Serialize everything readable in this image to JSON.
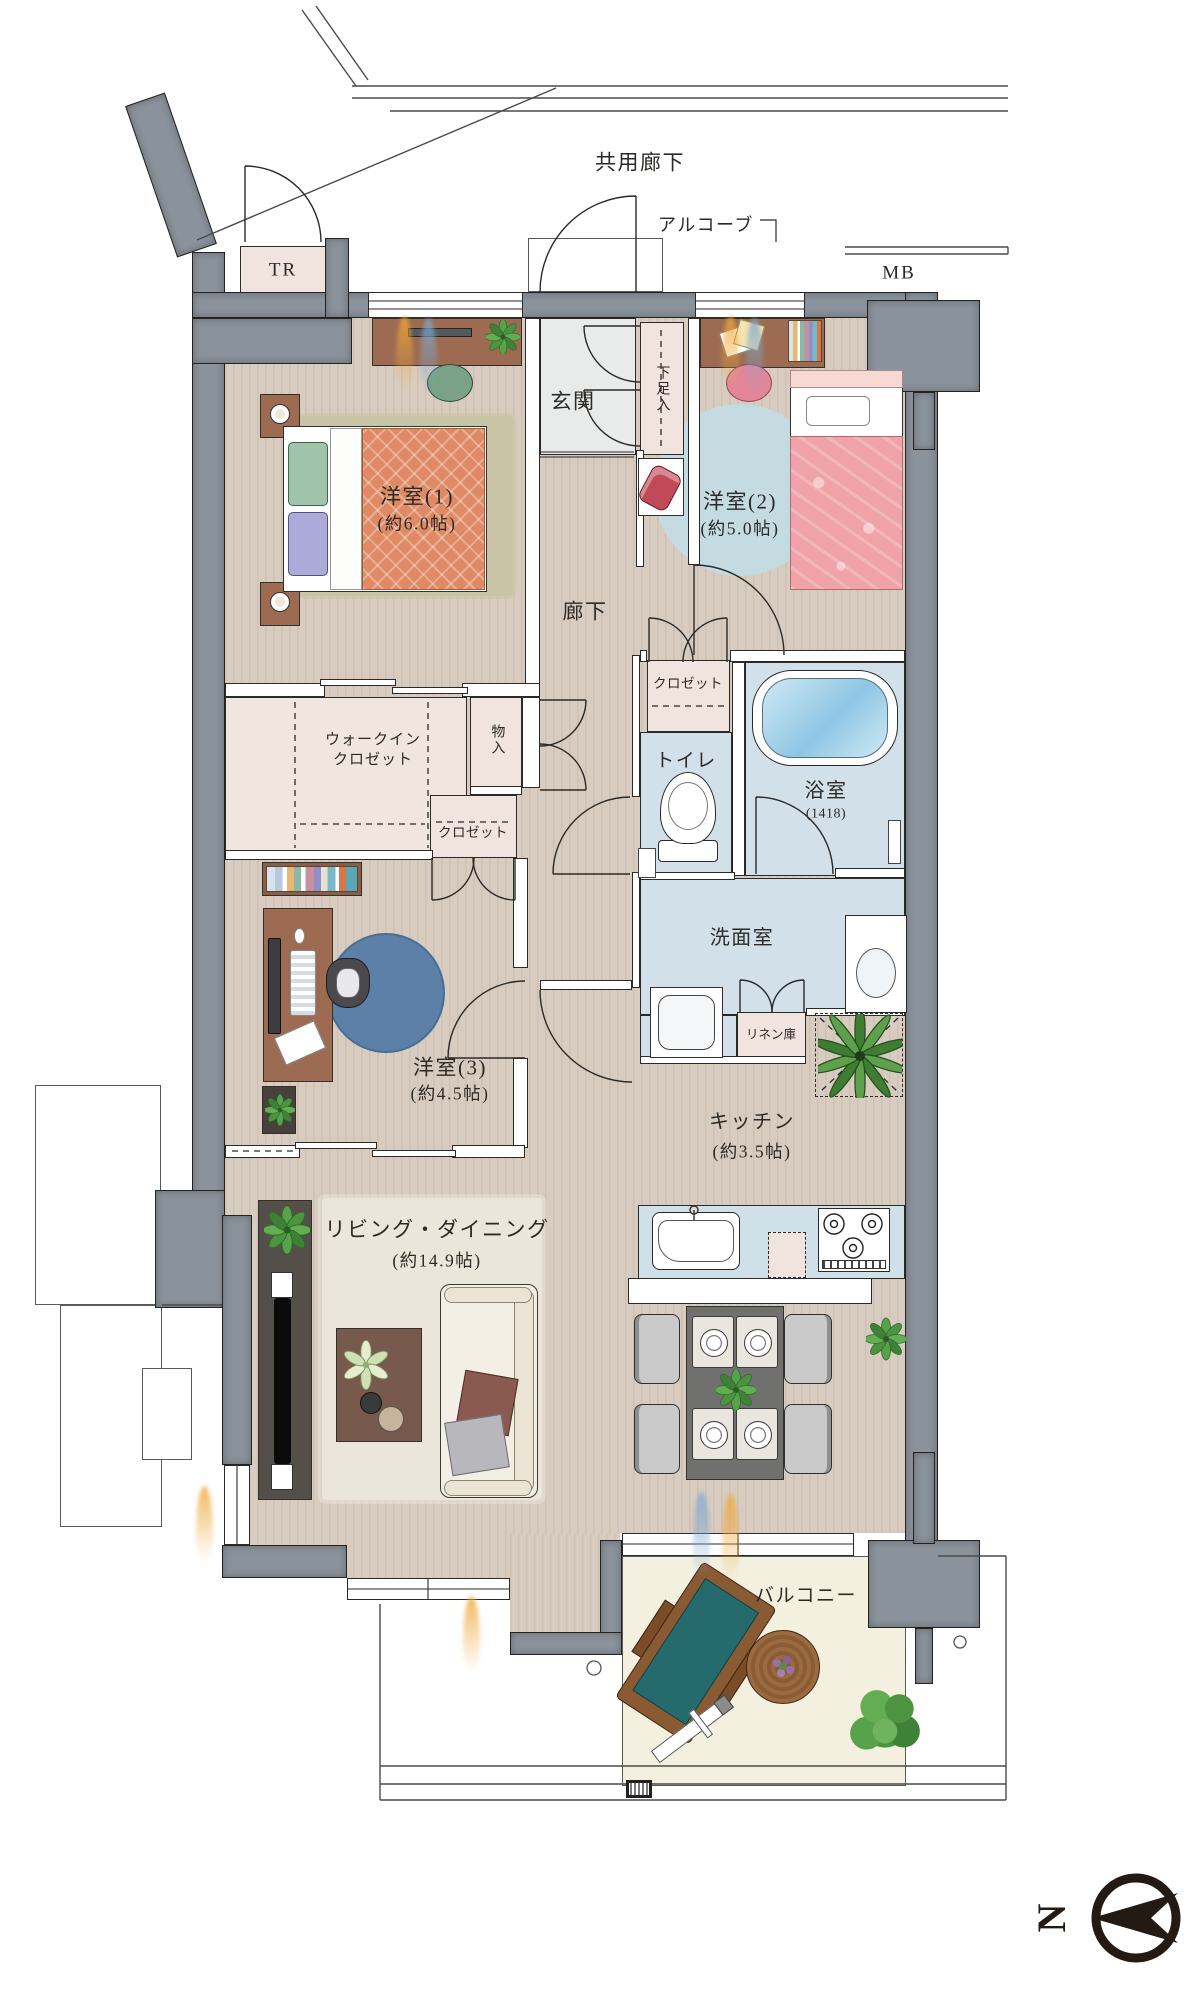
{
  "exterior": {
    "common_corridor": "共用廊下",
    "alcove": "アルコーブ",
    "trunk_room": "TR",
    "meter_box": "MB",
    "compass_north": "N"
  },
  "rooms": {
    "entrance": {
      "label": "玄関"
    },
    "shoe_cabinet": {
      "label": "下足入"
    },
    "western_room_1": {
      "label": "洋室(1)",
      "area": "(約6.0帖)"
    },
    "western_room_2": {
      "label": "洋室(2)",
      "area": "(約5.0帖)"
    },
    "western_room_3": {
      "label": "洋室(3)",
      "area": "(約4.5帖)"
    },
    "hallway": {
      "label": "廊下"
    },
    "closet_room2": {
      "label": "クロゼット"
    },
    "closet_room3": {
      "label": "クロゼット"
    },
    "walk_in_closet": {
      "label_line1": "ウォークイン",
      "label_line2": "クロゼット"
    },
    "storage": {
      "label": "物入"
    },
    "toilet": {
      "label": "トイレ"
    },
    "bathroom": {
      "label": "浴室",
      "size": "(1418)"
    },
    "washroom": {
      "label": "洗面室"
    },
    "linen_closet": {
      "label": "リネン庫"
    },
    "kitchen": {
      "label": "キッチン",
      "area": "(約3.5帖)"
    },
    "living_dining": {
      "label": "リビング・ダイニング",
      "area": "(約14.9帖)"
    },
    "balcony": {
      "label": "バルコニー"
    }
  },
  "colors": {
    "wall": "#8a929b",
    "wood_floor": "#d8ccc0",
    "wet_floor": "#d2e1e9",
    "closet_floor": "#f1e3dd",
    "entrance_floor": "#e9ebeb",
    "balcony_floor": "#f3f0e0",
    "text": "#2b2a26",
    "bed1_cover": "#df8a64",
    "bed2_cover": "#efa3a8",
    "rug_room2": "#c3dbe1",
    "rug_room3": "#5c80a7"
  }
}
